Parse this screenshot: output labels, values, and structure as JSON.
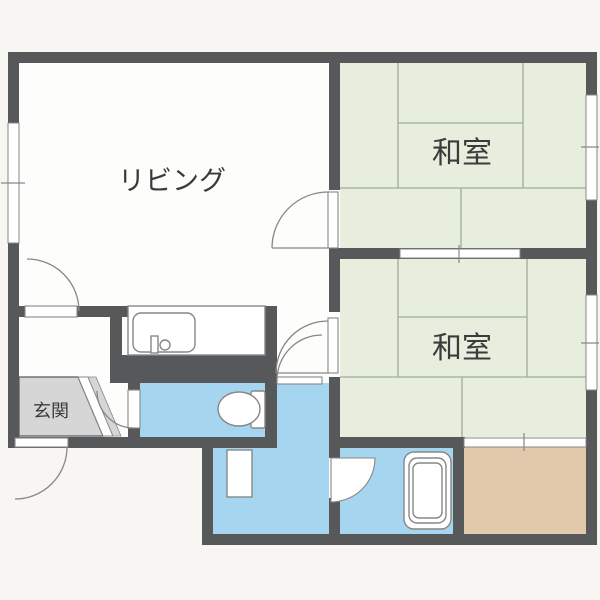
{
  "title": "apartment-floor-plan",
  "rooms": {
    "living": {
      "label": "リビング"
    },
    "japanese_room_top": {
      "label": "和室"
    },
    "japanese_room_bottom": {
      "label": "和室"
    },
    "entrance": {
      "label": "玄関"
    }
  },
  "fixtures": {
    "kitchen_sink": "kitchen-counter-with-sink",
    "toilet": "toilet-bowl-and-tank",
    "bathtub": "bathtub",
    "vanity": "wash-basin"
  },
  "colors": {
    "bg": "#f7f6f2",
    "floor": "#fdfdfc",
    "wall": "#57585a",
    "tatami": "#e7eede",
    "tatami-line": "#a0ab9b",
    "water": "#a6d5ef",
    "balcony": "#e2c9ab",
    "entrance-floor": "#d6d6d6",
    "outline": "#878787",
    "text": "#3b3b3b"
  }
}
